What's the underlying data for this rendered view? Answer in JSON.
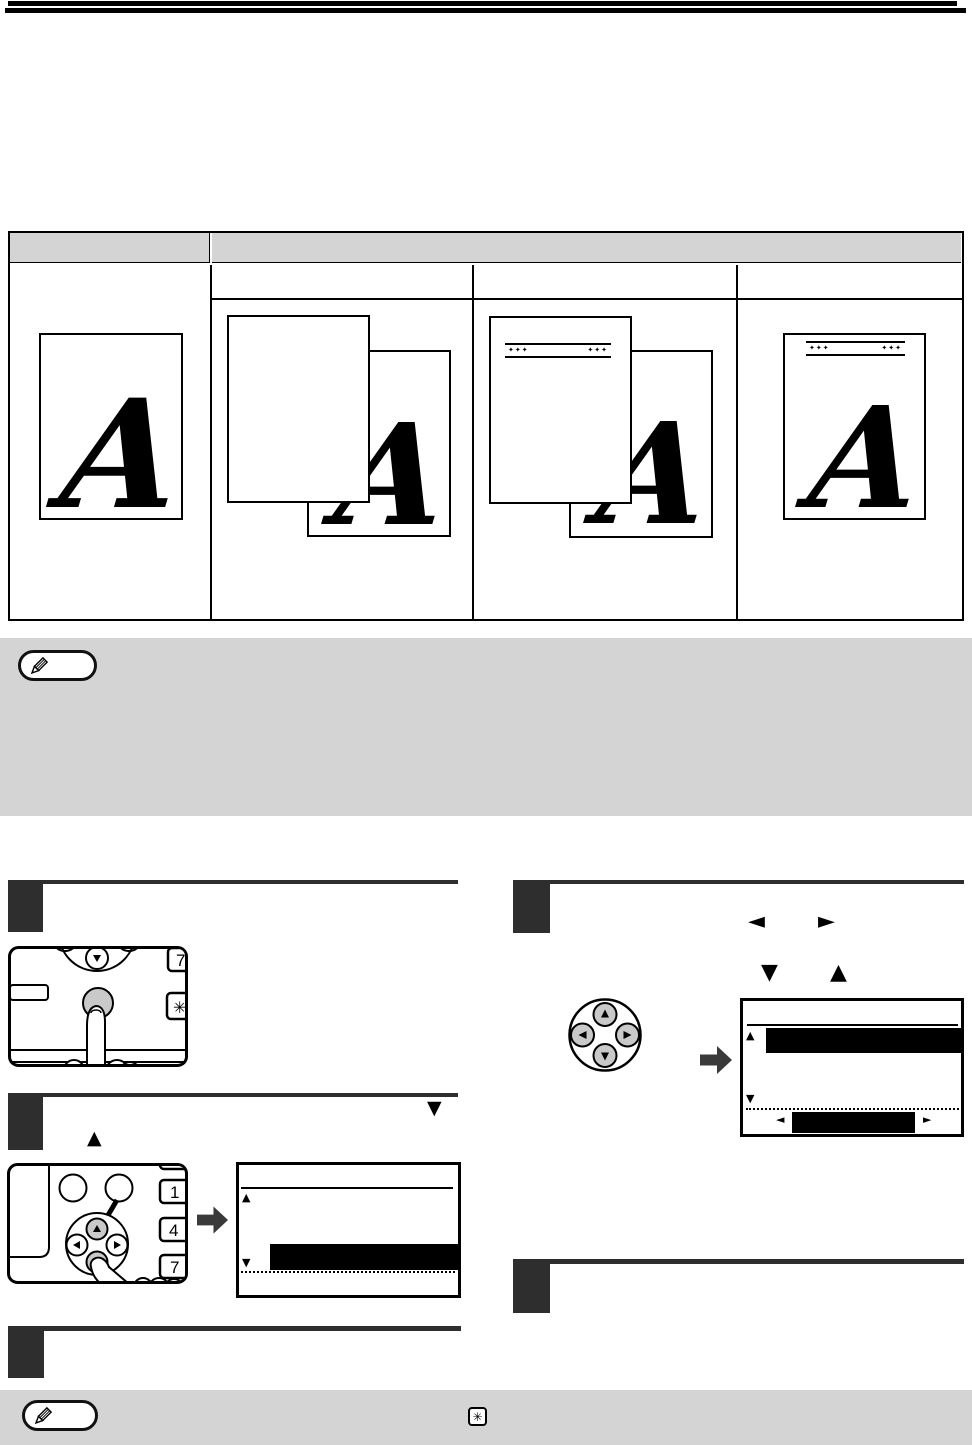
{
  "colors": {
    "page_bg": "#ffffff",
    "top_bars": "#000000",
    "note_box_bg": "#d4d4d4",
    "step_badge": "#2e2e2e",
    "illustration_button_gray": "#c9c9c9",
    "transition_arrow": "#3a3a3a",
    "lcd_highlight": "#000000"
  },
  "table": {
    "letter": "A",
    "corner_marks": "✦✦✦"
  },
  "illustrations": {
    "panel1": {
      "key_7": "7",
      "key_asterisk": "✳"
    },
    "panel2": {
      "key_1": "1",
      "key_4": "4",
      "key_7": "7"
    }
  },
  "inline_keys": {
    "left": "◄",
    "right": "►",
    "up": "▲",
    "down": "▼"
  },
  "notes": {
    "asterisk_key": "✳"
  }
}
